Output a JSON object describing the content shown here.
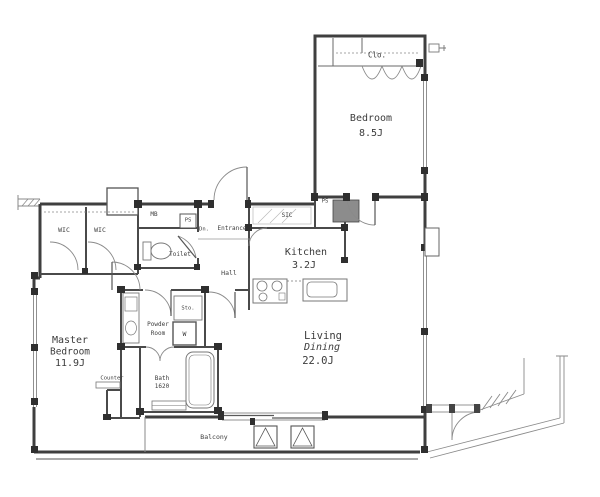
{
  "title": "apartment-floor-plan",
  "colors": {
    "background": "#ffffff",
    "wall": "#3f3f3f",
    "thin_line": "#8a8a8a",
    "text": "#3c3c3c",
    "duct_fill": "#8c8c8c"
  },
  "rooms": {
    "bedroom": {
      "name": "Bedroom",
      "size": "8.5J"
    },
    "master": {
      "line1": "Master",
      "line2": "Bedroom",
      "size": "11.9J"
    },
    "living": {
      "line1": "Living",
      "line2": "Dining",
      "size": "22.0J"
    },
    "kitchen": {
      "name": "Kitchen",
      "size": "3.2J"
    },
    "powder": {
      "line1": "Powder",
      "line2": "Room"
    },
    "bath": {
      "name": "Bath",
      "size": "1620"
    },
    "balcony": {
      "name": "Balcony"
    },
    "hall": {
      "name": "Hall"
    },
    "toilet": {
      "name": "Toilet"
    },
    "entrance": {
      "name": "Entrance"
    }
  },
  "closets": {
    "clo": "Clo.",
    "wic_left": "WIC",
    "wic_right": "WIC",
    "sic": "SIC",
    "sto": "Sto."
  },
  "utilities": {
    "mb": "MB",
    "ps_entry": "PS",
    "ps_kitchen": "PS",
    "washer": "W",
    "counter": "Counter",
    "down_step": "Dn."
  }
}
